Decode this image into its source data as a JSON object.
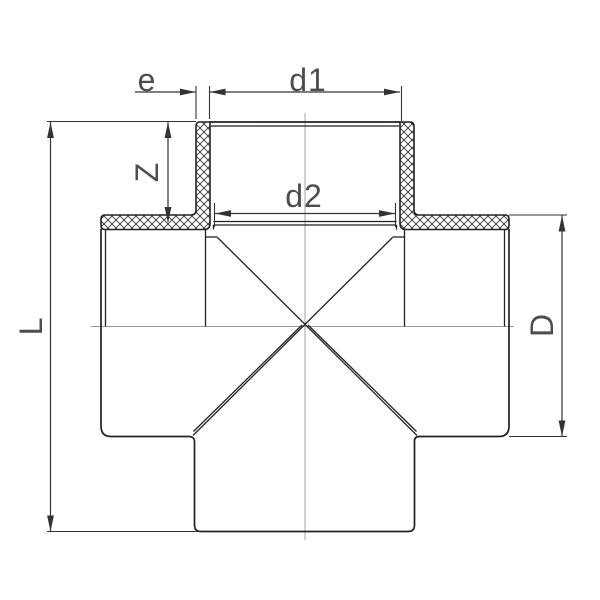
{
  "drawing": {
    "labels": {
      "e": "e",
      "d1": "d1",
      "d2": "d2",
      "Z": "Z",
      "L": "L",
      "D": "D"
    },
    "colors": {
      "background": "#ffffff",
      "outline": "#222222",
      "dimension": "#333333",
      "centerline": "#999999",
      "label_text": "#4d4d4d"
    }
  }
}
